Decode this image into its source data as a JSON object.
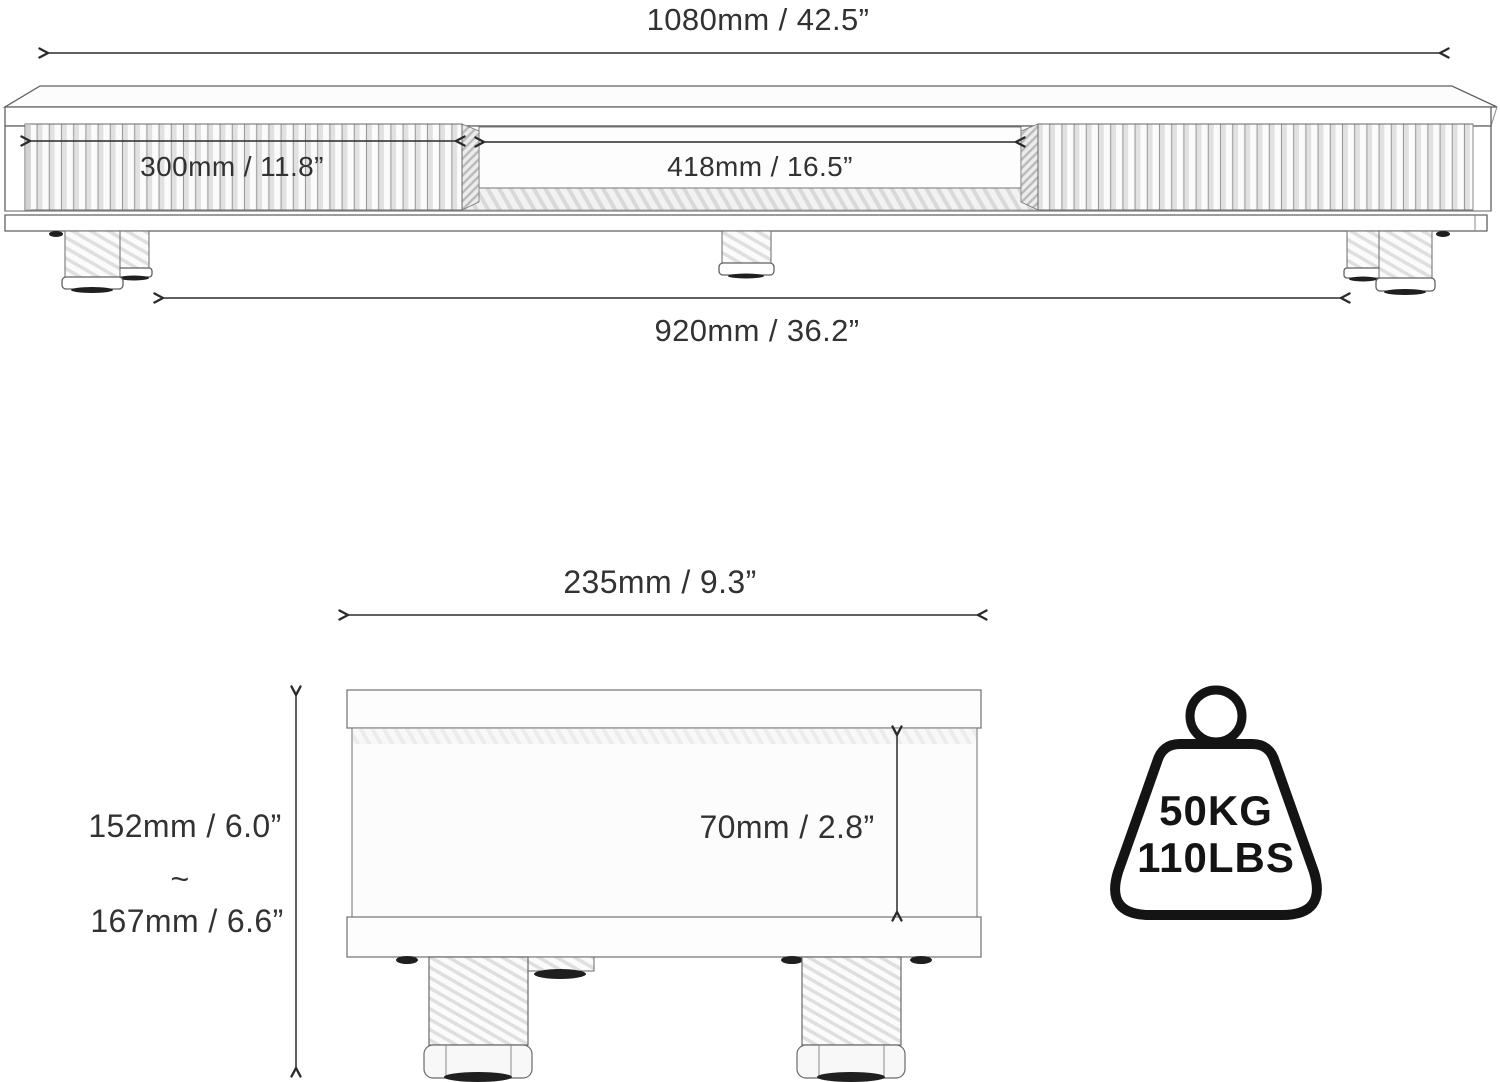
{
  "front": {
    "overall_width": "1080mm / 42.5”",
    "drawer_width": "300mm / 11.8”",
    "opening_width": "418mm / 16.5”",
    "leg_span": "920mm / 36.2”"
  },
  "side": {
    "depth": "235mm / 9.3”",
    "min_height": "152mm / 6.0”",
    "range_separator": "~",
    "max_height": "167mm / 6.6”",
    "inner_height": "70mm / 2.8”"
  },
  "load": {
    "kg": "50KG",
    "lbs": "110LBS"
  },
  "icons": {
    "weight": "kettlebell-weight-capacity-icon"
  },
  "colors": {
    "line": "#606060",
    "dimension_line": "#2b2b2b",
    "text": "#323232",
    "icon": "#141414",
    "background": "#ffffff"
  }
}
